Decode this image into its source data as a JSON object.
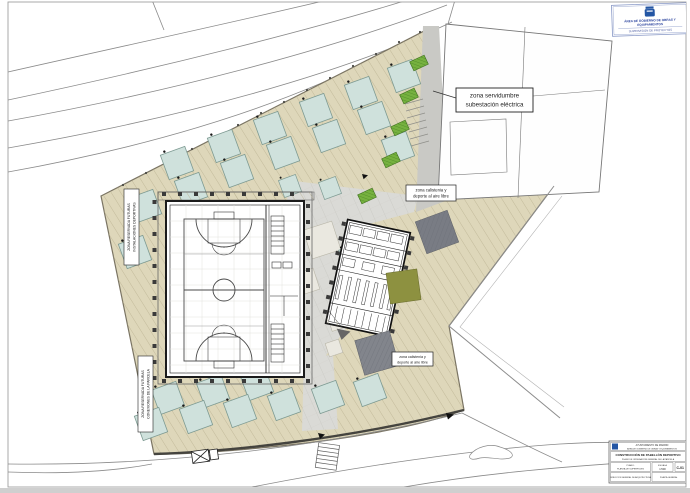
{
  "drawing": {
    "callouts": {
      "servidumbre_line1": "zona servidumbre",
      "servidumbre_line2": "subestación eléctrica",
      "calistenia_top_line1": "zona calistenia y",
      "calistenia_top_line2": "deporte al aire libre",
      "calistenia_bottom_line1": "zona calistenia y",
      "calistenia_bottom_line2": "deporte al aire libre",
      "reserve_left_line1": "ZONA RESERVADA FUTURAS",
      "reserve_left_line2": "INSTALACIONES DEPORTIVAS",
      "reserve_bottom_line1": "ZONA RESERVADA FUTURAS",
      "reserve_bottom_line2": "CONEXIONES DE LA PARCELA"
    },
    "stamp": {
      "line1": "ÁREA DE GOBIERNO DE OBRAS Y",
      "line2": "EQUIPAMIENTOS",
      "line3": "SUPERVISIÓN DE PROYECTOS"
    },
    "title_block": {
      "org_line1": "AYUNTAMIENTO DE MADRID",
      "org_line2": "ÁREA DE GOBIERNO DE OBRAS Y EQUIPAMIENTOS",
      "project_title": "CONSTRUCCIÓN DE PABELLÓN DEPORTIVO",
      "project_subtitle": "PLANO DE ORDENACIÓN GENERAL DE LA PARCELA",
      "cell_plan_line1": "PLANO:",
      "cell_plan_line2": "PLANTA DE SUPERFICIES",
      "scale_label": "ESCALA",
      "scale_value": "1:500",
      "sheet_code": "C-01",
      "cell_bottom_left": "DIRECCIÓN GENERAL DE ARQUITECTURA",
      "cell_bottom_right": "PLANTA GENERAL"
    },
    "colors": {
      "beige_terrain": "#ded7ba",
      "hatch_line": "#b6ad8c",
      "canopy_teal": "#cfe1dc",
      "plaza_gray": "#dadad6",
      "path_gray": "#c9c9c5",
      "dark_pad": "#797c84",
      "olive_pad": "#8d9140",
      "planting_green": "#76b13f",
      "brand_blue": "#2456a4"
    }
  }
}
